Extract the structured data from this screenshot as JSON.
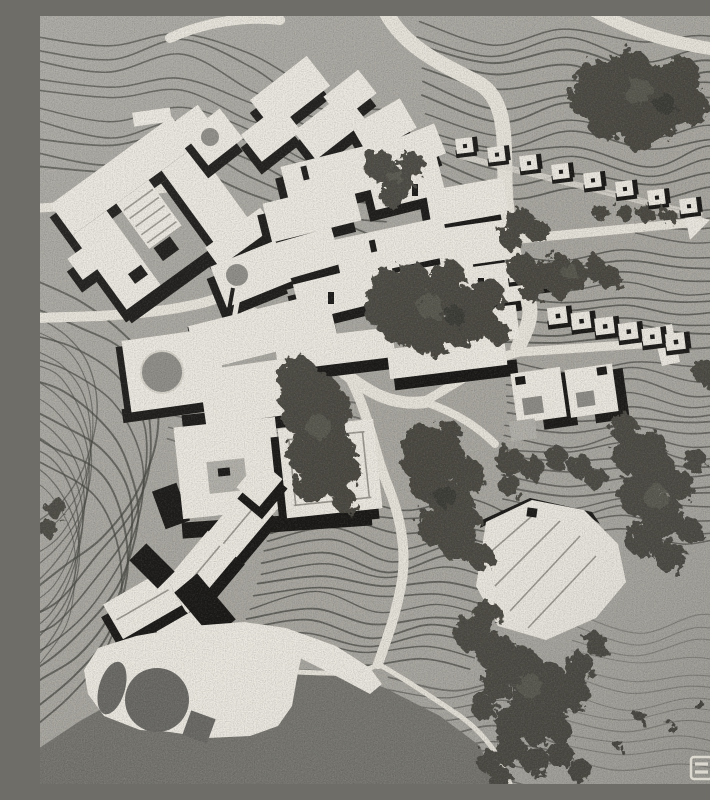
{
  "scene": {
    "description": "Black-and-white aerial photograph of an architectural site model: contour-lined hillside terrain with a dense village of flat-roofed blocks, rows of hillside houses along white roads, courtyard houses, a garden court with circular lawn, a folded-roof pavilion in tree groves, a waterfront plaza with circular and oval pools, and a dark lake at the bottom left",
    "medium": "monochrome photograph of a physical site model"
  },
  "palette": {
    "terrain": "#a9a7a0",
    "contour": "#45443f",
    "building": "#edeae2",
    "shadow": "#1a1917",
    "road": "#e8e5dc",
    "tree": "#4b4a43",
    "tree_light": "#67665b",
    "lake": "#76756f",
    "court_gray": "#8e8c86",
    "pool_dark": "#6b6a66",
    "detail_line": "#9a9890",
    "stamp": "#dcd9d0"
  },
  "features": {
    "central_village": "dense cluster of white stepped blocks with black cast shadows",
    "west_court_building": "large angled U-shaped complex with courtyard",
    "hillside_house_rows": "rows of small square houses stepping down the slope",
    "courtyard_houses": "square houses with gray inner courts",
    "garden_court": "walled court with circular gray lawn",
    "terrace_court_complex": "terraced platforms with round pond and inner court",
    "south_village": "gabled-roof buildings descending toward the water",
    "pavilion": "large folded-plate roof pavilion in the woods",
    "waterfront_plaza": "white deck with dark circular pool and oval pool",
    "lake": "dark water body at bottom left",
    "roads": "white curving roads, one ending in a T-shaped turnaround",
    "tree_groves": "dark mottled tree clusters",
    "contours": "closely spaced dark contour lines of the terrain model"
  },
  "counts": {
    "hillside_houses_row_1": 8,
    "hillside_houses_row_2": 6,
    "hillside_houses_upper_pair": 2,
    "courtyard_houses": 2,
    "plaza_pools": 2
  },
  "stamp": {
    "description": "two small light outlined squares, each containing two horizontal bars",
    "glyph_count": 2
  }
}
